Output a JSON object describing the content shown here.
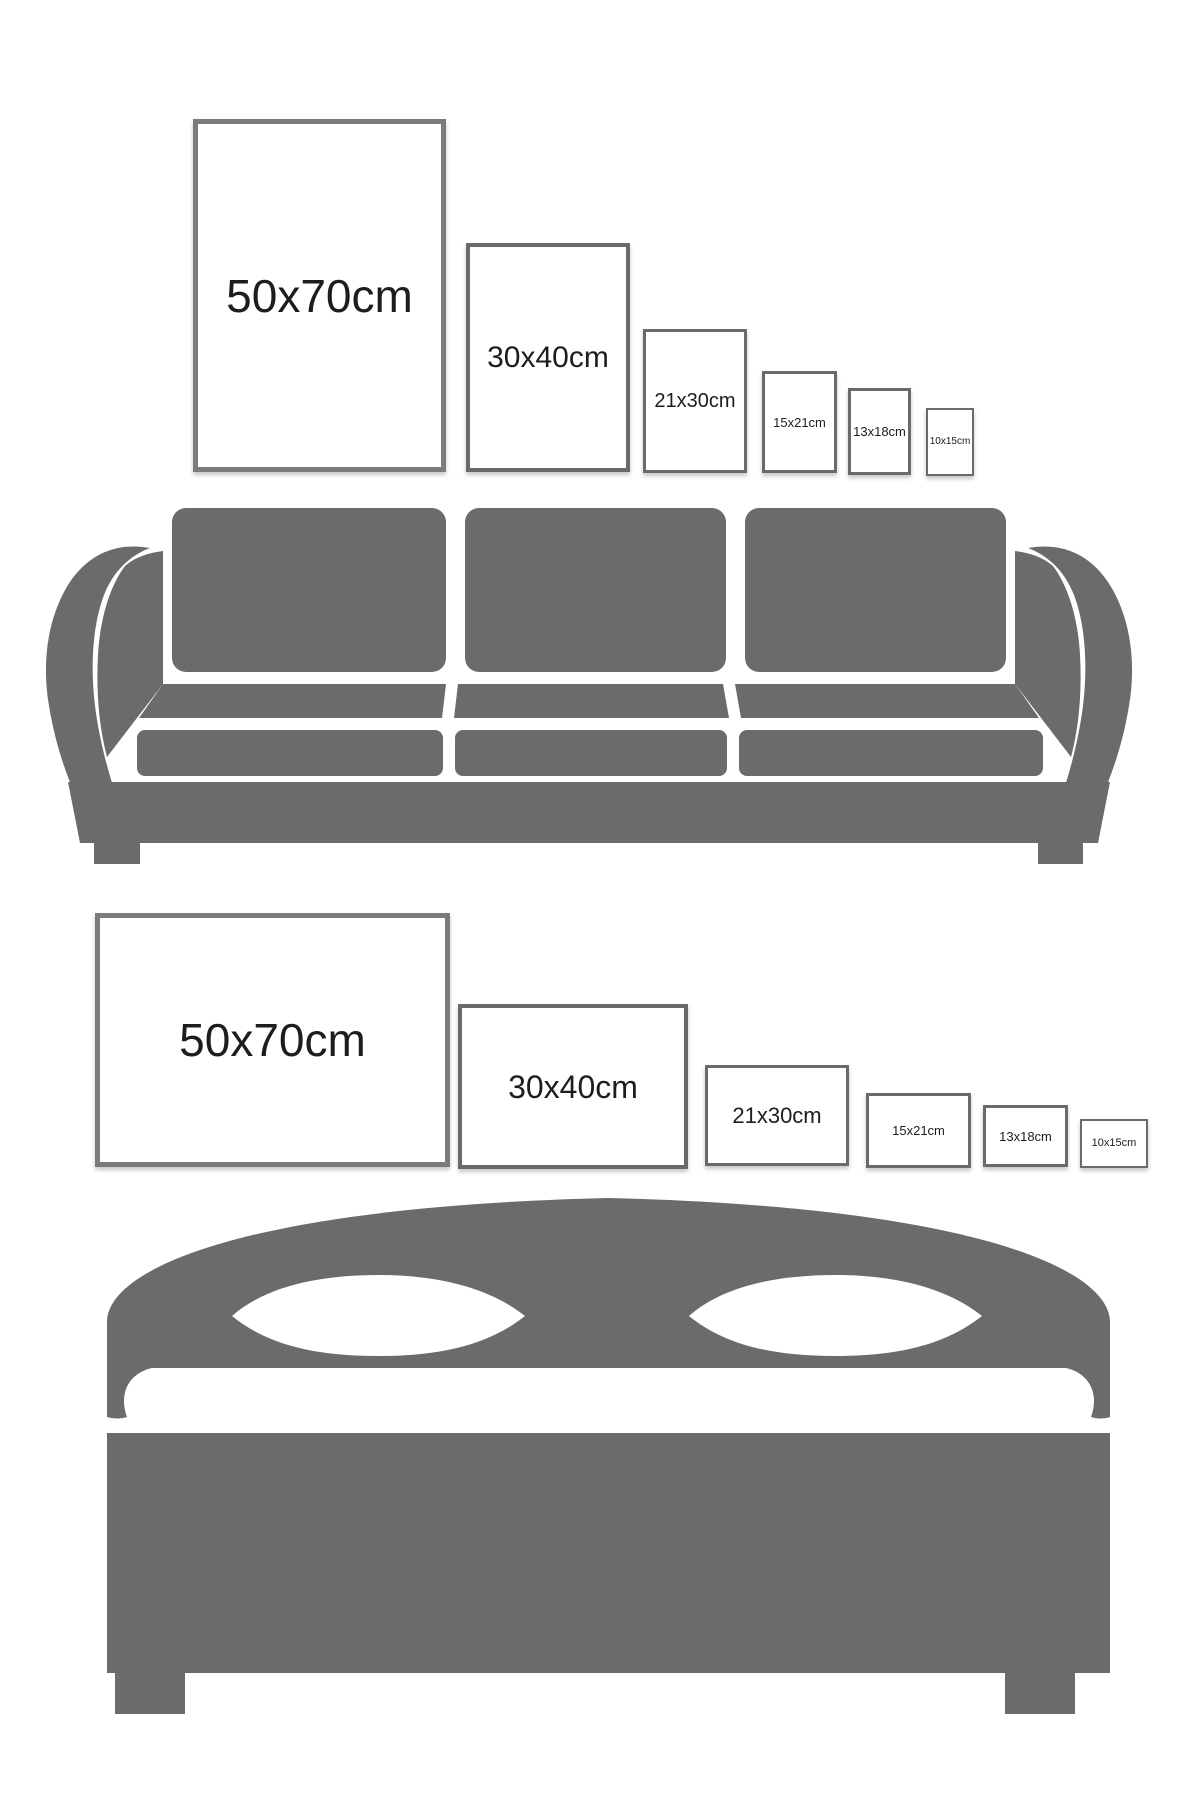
{
  "colors": {
    "background": "#ffffff",
    "furniture": "#6b6b6b",
    "frame_border_large": "#7b7b7b",
    "frame_border_small": "#6a6a6a",
    "label_text": "#1d1d1d"
  },
  "sections": [
    {
      "id": "sofa-wall",
      "furniture": "sofa",
      "frame_orientation": "portrait",
      "frames": [
        {
          "label": "50x70cm",
          "left": 193,
          "top": 119,
          "width": 253,
          "height": 353,
          "font": 46,
          "border": 5,
          "large": true
        },
        {
          "label": "30x40cm",
          "left": 466,
          "top": 243,
          "width": 164,
          "height": 229,
          "font": 30,
          "border": 4,
          "large": false
        },
        {
          "label": "21x30cm",
          "left": 643,
          "top": 329,
          "width": 104,
          "height": 144,
          "font": 20,
          "border": 3,
          "large": false
        },
        {
          "label": "15x21cm",
          "left": 762,
          "top": 371,
          "width": 75,
          "height": 102,
          "font": 13,
          "border": 3,
          "large": false
        },
        {
          "label": "13x18cm",
          "left": 848,
          "top": 388,
          "width": 63,
          "height": 87,
          "font": 13,
          "border": 3,
          "large": false
        },
        {
          "label": "10x15cm",
          "left": 926,
          "top": 408,
          "width": 48,
          "height": 68,
          "font": 10,
          "border": 2,
          "large": false
        }
      ]
    },
    {
      "id": "bed-wall",
      "furniture": "bed",
      "frame_orientation": "landscape",
      "frames": [
        {
          "label": "50x70cm",
          "left": 95,
          "top": 913,
          "width": 355,
          "height": 254,
          "font": 46,
          "border": 5,
          "large": true
        },
        {
          "label": "30x40cm",
          "left": 458,
          "top": 1004,
          "width": 230,
          "height": 165,
          "font": 32,
          "border": 4,
          "large": false
        },
        {
          "label": "21x30cm",
          "left": 705,
          "top": 1065,
          "width": 144,
          "height": 101,
          "font": 22,
          "border": 3,
          "large": false
        },
        {
          "label": "15x21cm",
          "left": 866,
          "top": 1093,
          "width": 105,
          "height": 75,
          "font": 13,
          "border": 3,
          "large": false
        },
        {
          "label": "13x18cm",
          "left": 983,
          "top": 1105,
          "width": 85,
          "height": 62,
          "font": 13,
          "border": 3,
          "large": false
        },
        {
          "label": "10x15cm",
          "left": 1080,
          "top": 1119,
          "width": 68,
          "height": 49,
          "font": 11,
          "border": 2,
          "large": false
        }
      ]
    }
  ]
}
